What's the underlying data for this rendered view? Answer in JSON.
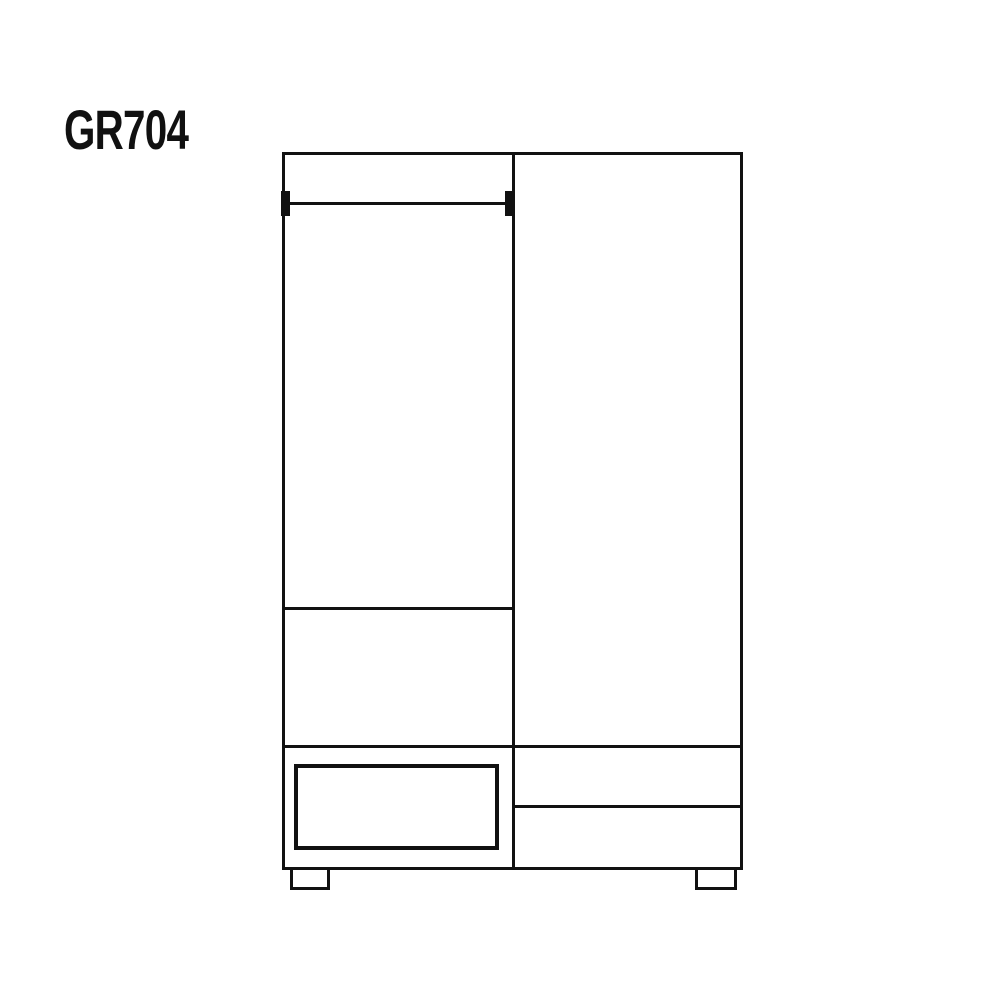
{
  "theme": {
    "bg-color": "#ffffff",
    "line-color": "#111111"
  },
  "label": {
    "text": "GR704"
  },
  "diagram": {
    "type": "furniture-line-drawing",
    "subject": "wardrobe front elevation",
    "parts": [
      "cabinet-outline",
      "center-divider-line",
      "hanging-rail",
      "rail-end-cap-left",
      "rail-end-cap-right",
      "shelf-line",
      "drawer-section-top-line",
      "left-drawer-front",
      "right-drawer-divider-line",
      "foot-left",
      "foot-right"
    ]
  }
}
